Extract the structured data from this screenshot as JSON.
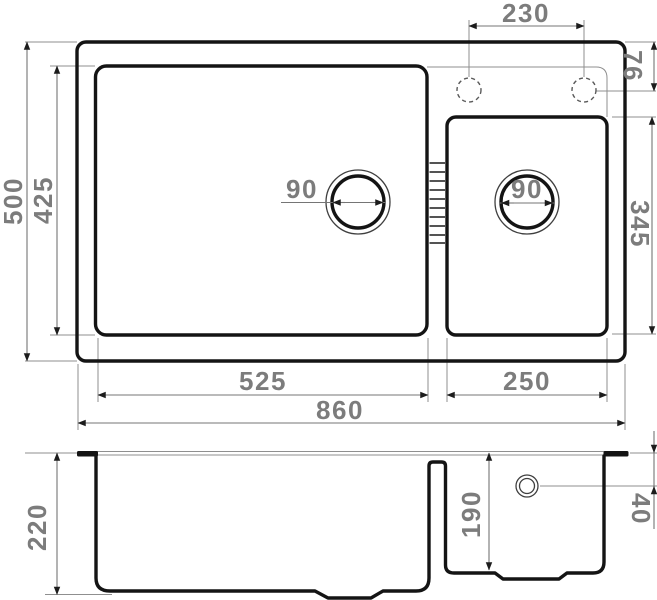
{
  "drawing_type": "kitchen sink dimensional drawing",
  "colors": {
    "outline": "#141414",
    "dim_line": "#757575",
    "ext_line": "#8f8f8f",
    "arrow": "#1c1c1c",
    "label": "#7c7c7c",
    "background": "#ffffff"
  },
  "views": {
    "top": {
      "labels": {
        "faucet_spacing": "230",
        "faucet_offset": "76",
        "overall_depth": "500",
        "main_bowl_depth": "425",
        "main_drain_diameter": "90",
        "second_drain_diameter": "90",
        "second_bowl_length": "345",
        "main_bowl_width": "525",
        "second_bowl_width": "250",
        "overall_width": "860"
      }
    },
    "section": {
      "labels": {
        "main_bowl_height": "220",
        "second_bowl_height": "190",
        "drain_center_offset": "40"
      }
    }
  }
}
